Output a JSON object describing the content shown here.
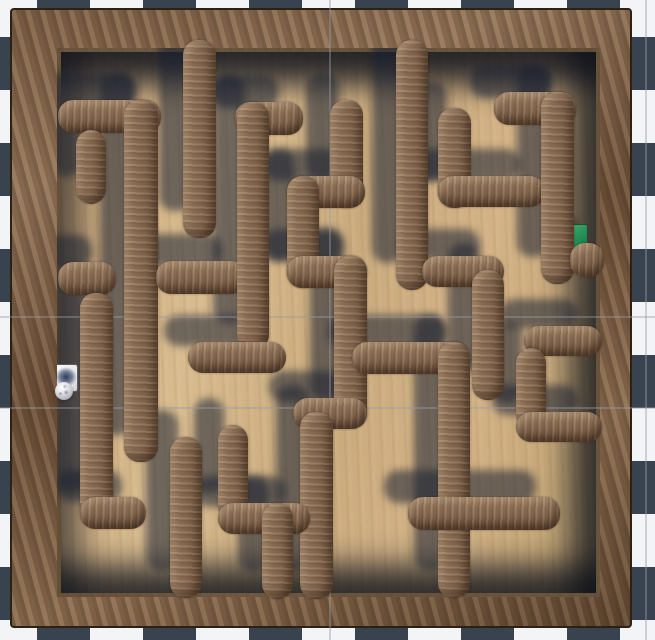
{
  "scene": {
    "width": 655,
    "height": 640,
    "description": "top-down 3d wooden labyrinth game view",
    "background": {
      "pattern": "checkerboard",
      "square_size": 53,
      "offset_x": -16,
      "offset_y": -16,
      "dark_color": "#394350",
      "light_color": "#f3f4f5"
    },
    "grid_lines": {
      "color": "rgba(150,155,165,0.42)",
      "vertical_x": [
        329,
        645
      ],
      "horizontal_y": [
        316,
        407
      ]
    }
  },
  "frame": {
    "x": 10,
    "y": 8,
    "w": 622,
    "h": 620,
    "wood_color": "#7c5f45",
    "edge_color": "#2c2115"
  },
  "floor": {
    "x": 57,
    "y": 48,
    "w": 543,
    "h": 549,
    "wood_color": "#cdae81"
  },
  "maze": {
    "wall_thickness": 32,
    "wall_color": "#8a6d54",
    "shadow_color": "rgba(25,33,50,0.55)",
    "shadow_offset_x": -24,
    "shadow_offset_y": -27,
    "walls": [
      {
        "name": "top-c2-v",
        "x": 183,
        "y": 40,
        "w": 33,
        "h": 198
      },
      {
        "name": "nw-gamma-h",
        "x": 58,
        "y": 100,
        "w": 103,
        "h": 33
      },
      {
        "name": "nw-stub-v",
        "x": 76,
        "y": 130,
        "w": 30,
        "h": 74
      },
      {
        "name": "west-long-v",
        "x": 124,
        "y": 100,
        "w": 34,
        "h": 362
      },
      {
        "name": "west-e-h",
        "x": 58,
        "y": 262,
        "w": 58,
        "h": 33
      },
      {
        "name": "west-g-h",
        "x": 156,
        "y": 261,
        "w": 90,
        "h": 33
      },
      {
        "name": "cl-top-h",
        "x": 235,
        "y": 102,
        "w": 68,
        "h": 33
      },
      {
        "name": "cl-long-v",
        "x": 237,
        "y": 102,
        "w": 32,
        "h": 248
      },
      {
        "name": "cl-t-h",
        "x": 188,
        "y": 342,
        "w": 98,
        "h": 31
      },
      {
        "name": "ball-l-v",
        "x": 80,
        "y": 293,
        "w": 33,
        "h": 226
      },
      {
        "name": "ball-l-h",
        "x": 80,
        "y": 497,
        "w": 66,
        "h": 32
      },
      {
        "name": "snake-v1",
        "x": 330,
        "y": 100,
        "w": 33,
        "h": 108
      },
      {
        "name": "snake-h1",
        "x": 287,
        "y": 176,
        "w": 78,
        "h": 32
      },
      {
        "name": "snake-v2",
        "x": 287,
        "y": 176,
        "w": 32,
        "h": 112
      },
      {
        "name": "snake-h2",
        "x": 287,
        "y": 256,
        "w": 80,
        "h": 32
      },
      {
        "name": "snake-v3",
        "x": 334,
        "y": 256,
        "w": 33,
        "h": 172
      },
      {
        "name": "snake-h3",
        "x": 293,
        "y": 398,
        "w": 74,
        "h": 31
      },
      {
        "name": "snake-v4",
        "x": 300,
        "y": 412,
        "w": 33,
        "h": 187
      },
      {
        "name": "rt-frame-v",
        "x": 396,
        "y": 40,
        "w": 32,
        "h": 250
      },
      {
        "name": "rt-elbow-h",
        "x": 422,
        "y": 256,
        "w": 82,
        "h": 31
      },
      {
        "name": "rt-stub-v",
        "x": 472,
        "y": 270,
        "w": 32,
        "h": 130
      },
      {
        "name": "bridge-h",
        "x": 352,
        "y": 342,
        "w": 118,
        "h": 32
      },
      {
        "name": "bridge-v",
        "x": 438,
        "y": 342,
        "w": 32,
        "h": 256
      },
      {
        "name": "mid-h",
        "x": 408,
        "y": 497,
        "w": 152,
        "h": 33
      },
      {
        "name": "lb-v",
        "x": 170,
        "y": 437,
        "w": 32,
        "h": 161
      },
      {
        "name": "zig-v1",
        "x": 218,
        "y": 425,
        "w": 30,
        "h": 96
      },
      {
        "name": "zig-h",
        "x": 218,
        "y": 503,
        "w": 92,
        "h": 31
      },
      {
        "name": "zig-v2",
        "x": 262,
        "y": 503,
        "w": 31,
        "h": 96
      },
      {
        "name": "tr-elbow-v",
        "x": 438,
        "y": 108,
        "w": 33,
        "h": 100
      },
      {
        "name": "tr-elbow-h",
        "x": 438,
        "y": 176,
        "w": 107,
        "h": 31
      },
      {
        "name": "pocket-top-h",
        "x": 524,
        "y": 326,
        "w": 78,
        "h": 30
      },
      {
        "name": "pocket-v",
        "x": 516,
        "y": 348,
        "w": 30,
        "h": 82
      },
      {
        "name": "pocket-bot-h",
        "x": 516,
        "y": 412,
        "w": 86,
        "h": 30
      },
      {
        "name": "goal-top-h",
        "x": 494,
        "y": 92,
        "w": 82,
        "h": 33
      },
      {
        "name": "goal-v",
        "x": 541,
        "y": 92,
        "w": 33,
        "h": 192
      },
      {
        "name": "goal-j-h",
        "x": 570,
        "y": 243,
        "w": 34,
        "h": 34
      }
    ]
  },
  "start_pad": {
    "x": 55,
    "y": 365,
    "w": 22,
    "h": 26,
    "color": "#eef0f3"
  },
  "goal_pad": {
    "x": 562,
    "y": 225,
    "w": 25,
    "h": 29,
    "color": "#27945a"
  },
  "ball": {
    "cx": 64,
    "cy": 391,
    "radius": 9,
    "color": "#d8d8dc",
    "shadow": {
      "cx": 66,
      "cy": 377,
      "rx": 11,
      "ry": 10,
      "color": "rgba(38,52,84,0.9)"
    }
  }
}
